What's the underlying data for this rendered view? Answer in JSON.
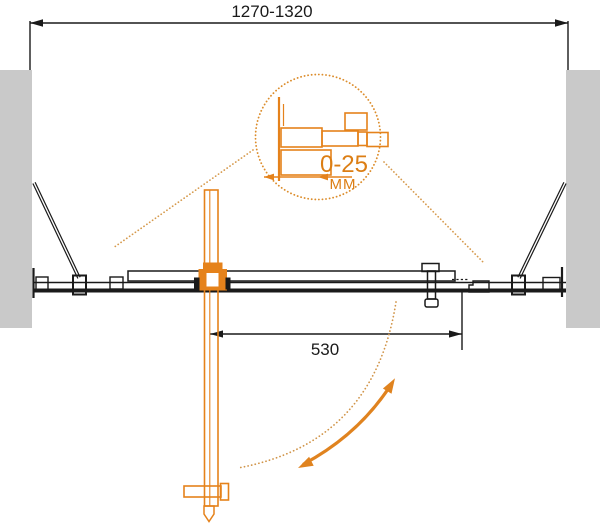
{
  "labels": {
    "overall_width": "1270-1320",
    "door_width": "530",
    "detail_range": "0-25",
    "detail_unit": "MM"
  },
  "colors": {
    "accent_orange": "#E5821B",
    "dotted_tan": "#D69A4D",
    "detail_circle_orange": "#DC8D2C",
    "wall_gray": "#C9C9C9",
    "line_black": "#1A1A1A",
    "background": "#FFFFFF"
  }
}
